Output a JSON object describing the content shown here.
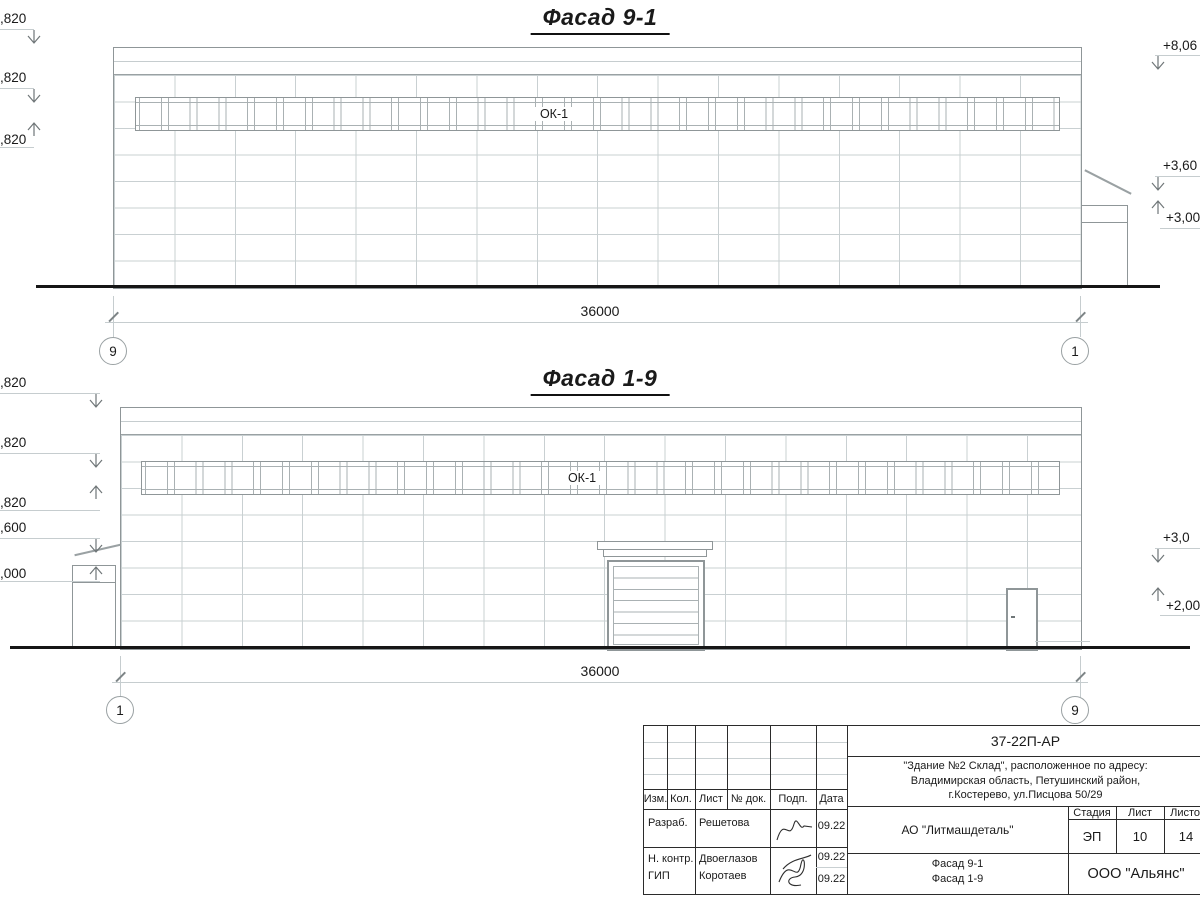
{
  "page": {
    "background": "#ffffff",
    "ink": "#1a1a1a",
    "line_light": "#c9d0d2",
    "line_medium": "#8f9698"
  },
  "facades": [
    {
      "title": "Фасад 9-1",
      "window_label": "ОК-1",
      "dimension": "36000",
      "axis_left": "9",
      "axis_right": "1",
      "elev_left": [
        ",820",
        ",820",
        ",820"
      ],
      "elev_right": [
        "+8,06",
        "+3,60",
        "+3,00"
      ]
    },
    {
      "title": "Фасад 1-9",
      "window_label": "ОК-1",
      "dimension": "36000",
      "axis_left": "1",
      "axis_right": "9",
      "elev_left": [
        ",820",
        ",820",
        ",820",
        ",600",
        ",000"
      ],
      "elev_right": [
        "+3,0",
        "+2,00"
      ]
    }
  ],
  "title_block": {
    "doc_code": "37-22П-АР",
    "address": [
      "\"Здание №2 Склад\", расположенное по адресу:",
      "Владимирская область, Петушинский район,",
      "г.Костерево, ул.Писцова 50/29"
    ],
    "rev_headers": [
      "Изм.",
      "Кол.",
      "Лист",
      "№ док.",
      "Подп.",
      "Дата"
    ],
    "rows": [
      {
        "role": "Разраб.",
        "name": "Решетова",
        "date": "09.22"
      },
      {
        "role": "Н. контр.",
        "name": "Двоеглазов",
        "date": "09.22"
      },
      {
        "role": "ГИП",
        "name": "Коротаев",
        "date": "09.22"
      }
    ],
    "company": "АО \"Литмашдеталь\"",
    "stage_header": "Стадия",
    "sheet_header": "Лист",
    "sheets_header": "Листов",
    "stage": "ЭП",
    "sheet": "10",
    "sheets": "14",
    "sheet_titles": [
      "Фасад 9-1",
      "Фасад 1-9"
    ],
    "org": "ООО \"Альянс\""
  }
}
